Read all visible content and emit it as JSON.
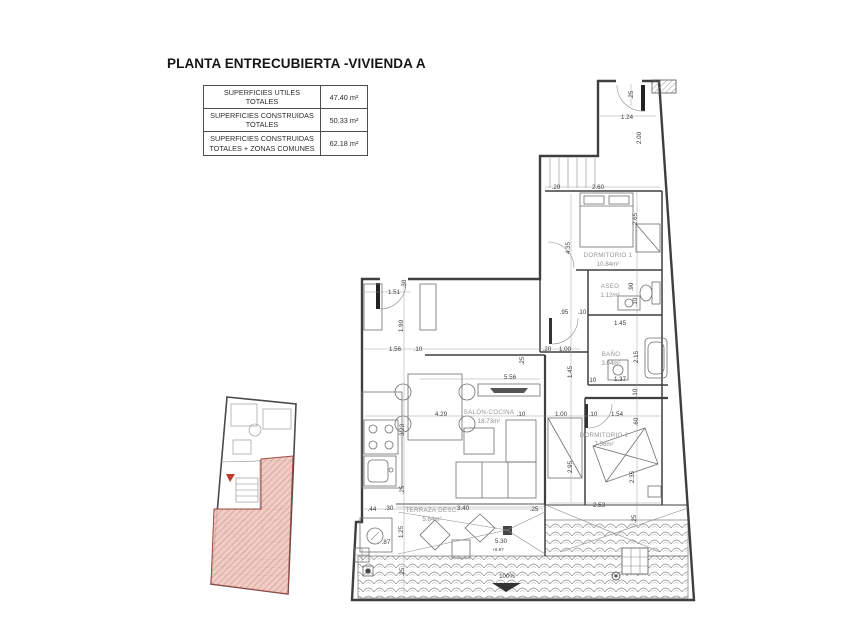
{
  "title": "PLANTA ENTRECUBIERTA -VIVIENDA A",
  "summary_table": {
    "rows": [
      {
        "label": "SUPERFICIES UTILES TOTALES",
        "value": "47.40 m²"
      },
      {
        "label": "SUPERFICIES CONSTRUIDAS TOTALES",
        "value": "50.33 m²"
      },
      {
        "label": "SUPERFICIES CONSTRUIDAS TOTALES + ZONAS COMUNES",
        "value": "62.18 m²"
      }
    ]
  },
  "plan": {
    "room_labels": [
      {
        "name": "DORMITORIO 1",
        "area": "10.84m²",
        "x": 608,
        "y": 257
      },
      {
        "name": "ASEO",
        "area": "1.12m²",
        "x": 610,
        "y": 288
      },
      {
        "name": "BAÑO",
        "area": "3.04m²",
        "x": 611,
        "y": 356
      },
      {
        "name": "DORMITORIO 2",
        "area": "7.56m²",
        "x": 604,
        "y": 437
      },
      {
        "name": "SALÓN-COCINA",
        "area": "18.73m²",
        "x": 489,
        "y": 414
      },
      {
        "name": "TERRAZA DESC.",
        "area": "5.84m²",
        "x": 432,
        "y": 512
      }
    ],
    "dim_labels": [
      {
        "t": ".25",
        "x": 633,
        "y": 95,
        "r": -90
      },
      {
        "t": "1.24",
        "x": 627,
        "y": 119
      },
      {
        "t": "2.00",
        "x": 641,
        "y": 138,
        "r": -90
      },
      {
        "t": ".20",
        "x": 556,
        "y": 189
      },
      {
        "t": "2.60",
        "x": 598,
        "y": 189
      },
      {
        "t": "2.65",
        "x": 637,
        "y": 219,
        "r": -90
      },
      {
        "t": "4.35",
        "x": 570,
        "y": 248,
        "r": -90
      },
      {
        "t": ".90",
        "x": 633,
        "y": 287,
        "r": -90
      },
      {
        "t": ".10",
        "x": 637,
        "y": 302,
        "r": -90
      },
      {
        "t": ".95",
        "x": 564,
        "y": 314
      },
      {
        "t": ".10",
        "x": 582,
        "y": 314
      },
      {
        "t": "1.45",
        "x": 620,
        "y": 325
      },
      {
        "t": ".20",
        "x": 547,
        "y": 351
      },
      {
        "t": "1.00",
        "x": 565,
        "y": 351
      },
      {
        "t": ".25",
        "x": 524,
        "y": 361,
        "r": -90
      },
      {
        "t": "1.45",
        "x": 572,
        "y": 372,
        "r": -90
      },
      {
        "t": "2.15",
        "x": 638,
        "y": 357,
        "r": -90
      },
      {
        "t": ".10",
        "x": 592,
        "y": 382
      },
      {
        "t": "1.37",
        "x": 620,
        "y": 381
      },
      {
        "t": ".10",
        "x": 637,
        "y": 393,
        "r": -90
      },
      {
        "t": ".10",
        "x": 593,
        "y": 416
      },
      {
        "t": "1.54",
        "x": 617,
        "y": 416
      },
      {
        "t": ".60",
        "x": 638,
        "y": 422,
        "r": -90
      },
      {
        "t": "2.95",
        "x": 572,
        "y": 467,
        "r": -90
      },
      {
        "t": "2.35",
        "x": 634,
        "y": 477,
        "r": -90
      },
      {
        "t": "2.53",
        "x": 599,
        "y": 507
      },
      {
        "t": ".25",
        "x": 636,
        "y": 519,
        "r": -90
      },
      {
        "t": "1.51",
        "x": 394,
        "y": 294
      },
      {
        "t": ".30",
        "x": 406,
        "y": 284,
        "r": -90
      },
      {
        "t": "1.90",
        "x": 403,
        "y": 326,
        "r": -90
      },
      {
        "t": "1.56",
        "x": 395,
        "y": 351
      },
      {
        "t": ".10",
        "x": 418,
        "y": 351
      },
      {
        "t": "5.56",
        "x": 510,
        "y": 379
      },
      {
        "t": "4.29",
        "x": 441,
        "y": 416
      },
      {
        "t": ".10",
        "x": 521,
        "y": 416
      },
      {
        "t": "1.00",
        "x": 561,
        "y": 416
      },
      {
        "t": "3.23",
        "x": 404,
        "y": 430,
        "r": -90
      },
      {
        "t": ".25",
        "x": 404,
        "y": 490,
        "r": -90
      },
      {
        "t": ".44",
        "x": 372,
        "y": 511
      },
      {
        "t": ".30",
        "x": 389,
        "y": 510
      },
      {
        "t": "3.40",
        "x": 463,
        "y": 510
      },
      {
        "t": ".25",
        "x": 534,
        "y": 511
      },
      {
        "t": "1.25",
        "x": 403,
        "y": 532,
        "r": -90
      },
      {
        "t": ".87",
        "x": 386,
        "y": 544
      },
      {
        "t": "5.30",
        "x": 501,
        "y": 543
      },
      {
        "t": "+9.67",
        "x": 498,
        "y": 551,
        "cls": "small"
      },
      {
        "t": ".25",
        "x": 404,
        "y": 572,
        "r": -90
      },
      {
        "t": "100%",
        "x": 507,
        "y": 578
      }
    ]
  },
  "colors": {
    "wall": "#3f3f3f",
    "dimension_text": "#3a3a3a",
    "room_text": "#979797",
    "highlight_fill": "#edc6be",
    "highlight_hatch": "#c4766d",
    "highlight_border": "#9c4a42",
    "marker_red": "#c0392b"
  }
}
